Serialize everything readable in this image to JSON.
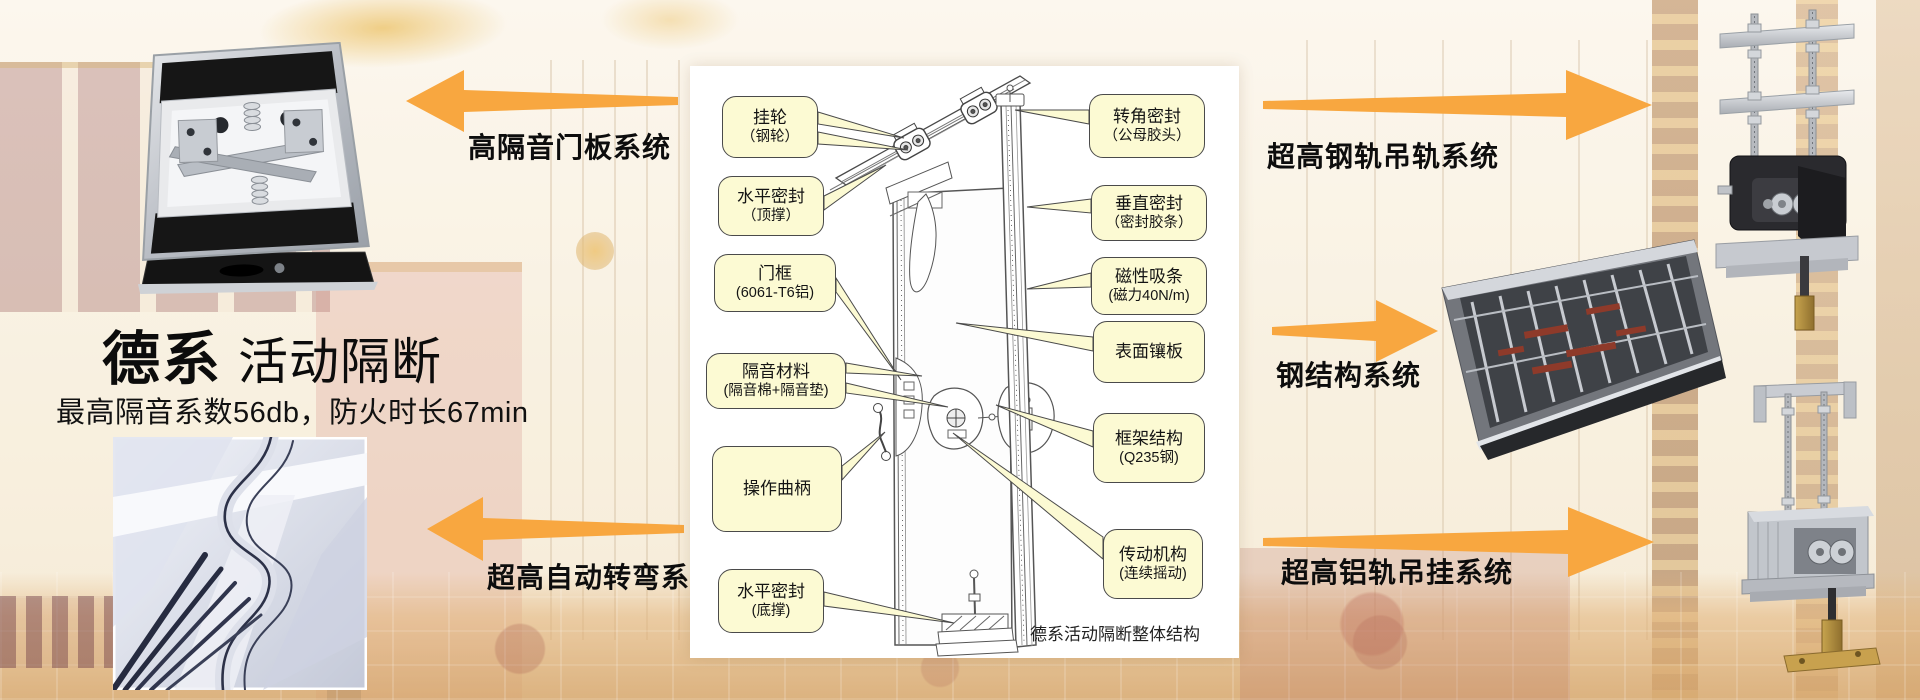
{
  "header": {
    "brand": "德系",
    "product": "活动隔断",
    "subtitle": "最高隔音系数56db，防火时长67min"
  },
  "system_labels": {
    "door_panel": "高隔音门板系统",
    "auto_turning": "超高自动转弯系统",
    "steel_rail_hanging": "超高钢轨吊轨系统",
    "steel_structure": "钢结构系统",
    "aluminum_rail_hanging": "超高铝轨吊挂系统"
  },
  "diagram": {
    "caption": "德系活动隔断整体结构",
    "callouts_left": [
      {
        "line1": "挂轮",
        "line2": "（钢轮）"
      },
      {
        "line1": "水平密封",
        "line2": "（顶撑）"
      },
      {
        "line1": "门框",
        "line2": "(6061-T6铝)"
      },
      {
        "line1": "隔音材料",
        "line2": "(隔音棉+隔音垫)"
      },
      {
        "line1": "操作曲柄",
        "line2": ""
      },
      {
        "line1": "水平密封",
        "line2": "(底撑)"
      }
    ],
    "callouts_right": [
      {
        "line1": "转角密封",
        "line2": "（公母胶头）"
      },
      {
        "line1": "垂直密封",
        "line2": "（密封胶条）"
      },
      {
        "line1": "磁性吸条",
        "line2": "(磁力40N/m)"
      },
      {
        "line1": "表面镶板",
        "line2": ""
      },
      {
        "line1": "框架结构",
        "line2": "(Q235钢)"
      },
      {
        "line1": "传动机构",
        "line2": "(连续摇动)"
      }
    ]
  },
  "colors": {
    "arrow_orange": "#F8A740",
    "callout_fill": "#FCFAD3",
    "callout_border": "#4A4A4A"
  }
}
